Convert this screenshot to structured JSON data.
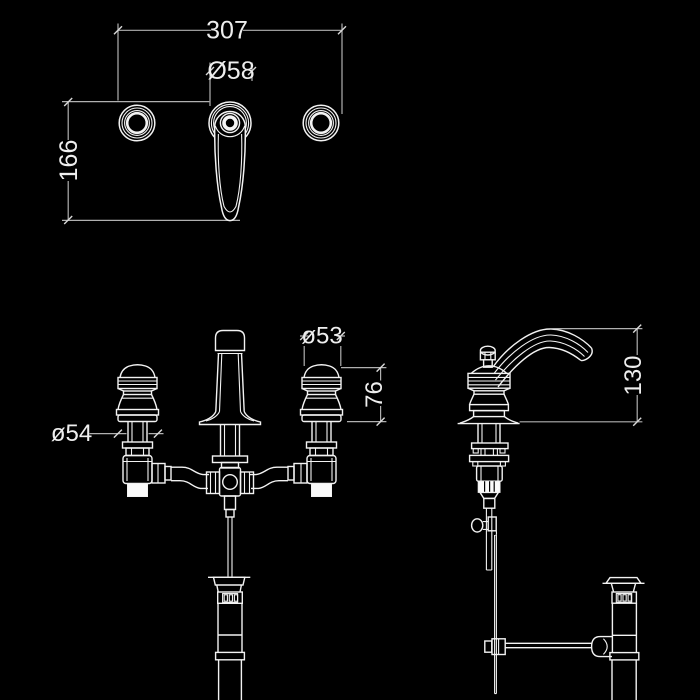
{
  "drawing": {
    "subject": "three-hole basin mixer tap with pop-up waste - specification drawing",
    "colors": {
      "background": "#000000",
      "line": "#f2f2f2",
      "dimension_line": "#b0b0b0",
      "label_text": "#eeeeee"
    },
    "views": {
      "top": {
        "dim_overall_width": "307",
        "dim_rosette_diameter": "Ø58",
        "dim_depth": "166"
      },
      "front": {
        "dim_left_handle_diameter": "ø54",
        "dim_right_handle_diameter": "ø53",
        "dim_handle_height": "76"
      },
      "side": {
        "dim_spout_height": "130"
      }
    }
  }
}
